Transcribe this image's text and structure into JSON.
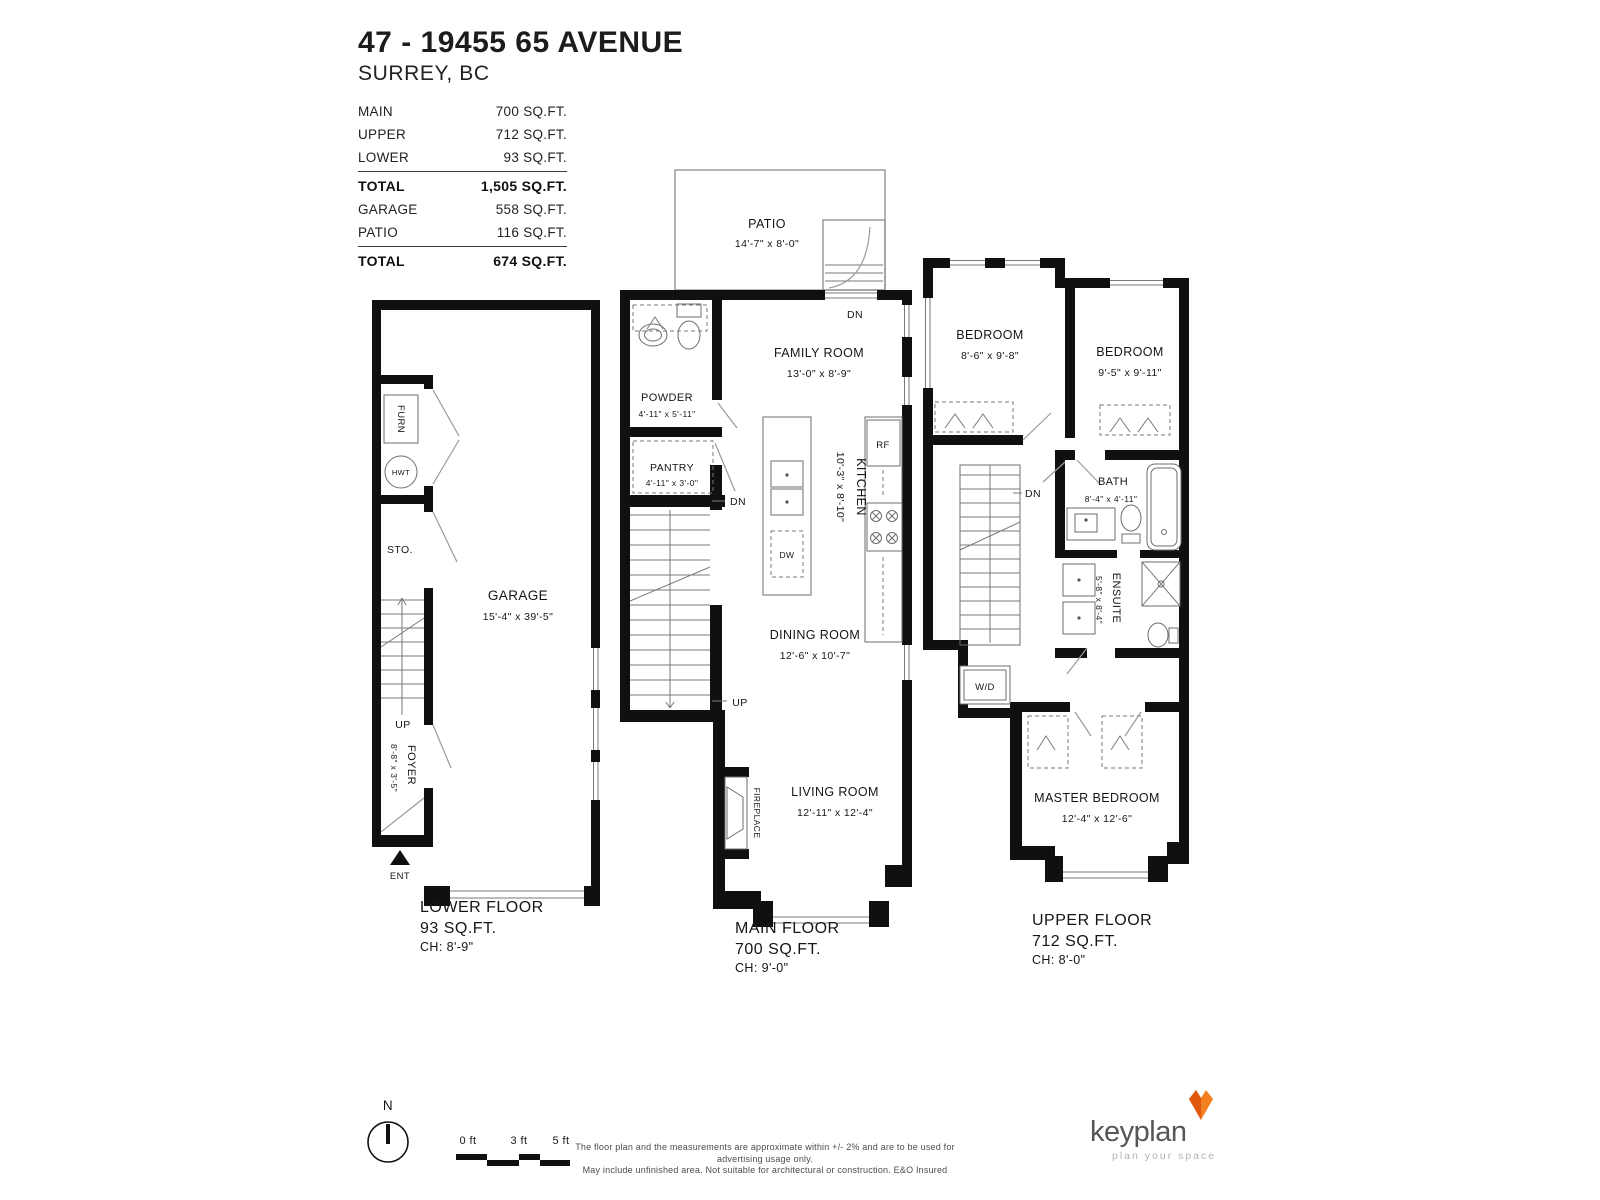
{
  "header": {
    "title": "47 - 19455 65 AVENUE",
    "subtitle": "SURREY, BC"
  },
  "area_table": {
    "rows": [
      {
        "label": "MAIN",
        "value": "700 SQ.FT."
      },
      {
        "label": "UPPER",
        "value": "712 SQ.FT."
      },
      {
        "label": "LOWER",
        "value": "93 SQ.FT."
      }
    ],
    "total_main": {
      "label": "TOTAL",
      "value": "1,505 SQ.FT."
    },
    "rows2": [
      {
        "label": "GARAGE",
        "value": "558 SQ.FT."
      },
      {
        "label": "PATIO",
        "value": "116 SQ.FT."
      }
    ],
    "total_other": {
      "label": "TOTAL",
      "value": "674 SQ.FT."
    }
  },
  "plans": {
    "lower": {
      "rooms": {
        "garage": {
          "name": "GARAGE",
          "dims": "15'-4\" x 39'-5\""
        },
        "foyer": {
          "name": "FOYER",
          "dims": "8'-8\" x 3'-5\""
        },
        "storage": {
          "name": "STO."
        },
        "furnace": {
          "name": "FURN"
        },
        "hot_water_tank": {
          "name": "HWT"
        }
      },
      "markers": {
        "up": "UP",
        "entry": "ENT"
      },
      "caption": {
        "name": "LOWER FLOOR",
        "area": "93 SQ.FT.",
        "ceiling": "CH: 8'-9\""
      }
    },
    "main": {
      "rooms": {
        "patio": {
          "name": "PATIO",
          "dims": "14'-7\" x 8'-0\""
        },
        "family": {
          "name": "FAMILY ROOM",
          "dims": "13'-0\" x 8'-9\""
        },
        "powder": {
          "name": "POWDER",
          "dims": "4'-11\" x 5'-11\""
        },
        "pantry": {
          "name": "PANTRY",
          "dims": "4'-11\" x 3'-0\""
        },
        "kitchen": {
          "name": "KITCHEN",
          "dims": "10'-3\" x 8'-10\""
        },
        "dining": {
          "name": "DINING ROOM",
          "dims": "12'-6\" x 10'-7\""
        },
        "living": {
          "name": "LIVING ROOM",
          "dims": "12'-11\" x 12'-4\""
        },
        "fireplace": {
          "name": "FIREPLACE"
        }
      },
      "appliances": {
        "fridge": "RF",
        "dishwasher": "DW"
      },
      "markers": {
        "dn_patio": "DN",
        "dn": "DN",
        "up": "UP"
      },
      "caption": {
        "name": "MAIN FLOOR",
        "area": "700 SQ.FT.",
        "ceiling": "CH: 9'-0\""
      }
    },
    "upper": {
      "rooms": {
        "bedroom1": {
          "name": "BEDROOM",
          "dims": "8'-6\" x 9'-8\""
        },
        "bedroom2": {
          "name": "BEDROOM",
          "dims": "9'-5\" x 9'-11\""
        },
        "bath": {
          "name": "BATH",
          "dims": "8'-4\" x 4'-11\""
        },
        "ensuite": {
          "name": "ENSUITE",
          "dims": "5'-8\" x 8'-4\""
        },
        "master": {
          "name": "MASTER BEDROOM",
          "dims": "12'-4\" x 12'-6\""
        },
        "laundry": {
          "name": "W/D"
        }
      },
      "markers": {
        "dn": "DN"
      },
      "caption": {
        "name": "UPPER FLOOR",
        "area": "712 SQ.FT.",
        "ceiling": "CH: 8'-0\""
      }
    }
  },
  "footer": {
    "compass_n": "N",
    "scale": {
      "t0": "0 ft",
      "t3": "3 ft",
      "t5": "5 ft"
    },
    "disclaimer1": "The floor plan and the measurements are approximate within +/- 2% and are to be used for advertising usage only.",
    "disclaimer2": "May include unfinished area. Not suitable for architectural or construction. E&O Insured",
    "brand": {
      "name": "keyplan",
      "tagline": "plan your space"
    },
    "colors": {
      "fox_orange": "#f4801f",
      "fox_dark": "#e0570e",
      "wall_black": "#101010"
    }
  }
}
